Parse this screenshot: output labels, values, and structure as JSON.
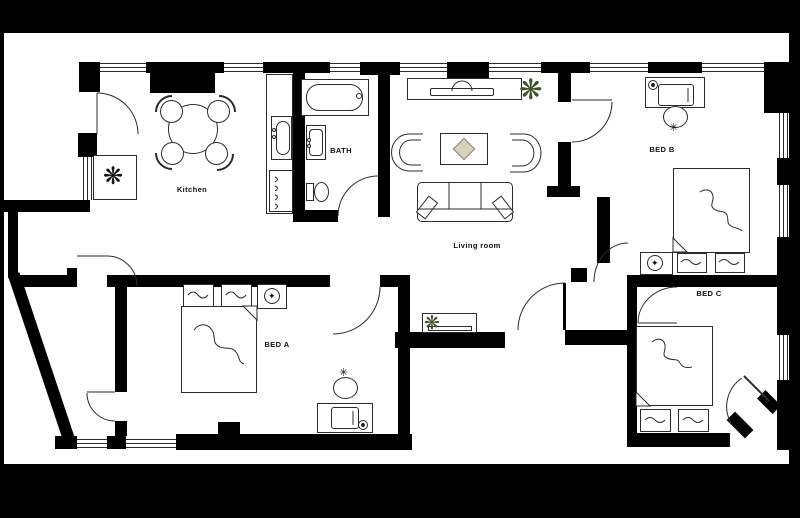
{
  "page": {
    "background": "#000000",
    "sheet": "#ffffff"
  },
  "colors": {
    "wall": "#000000",
    "line": "#2b2b2b",
    "plant_green": "#3d5226",
    "decor_beige": "#d8d0bd"
  },
  "rooms": [
    {
      "id": "kitchen",
      "label": "Kitchen"
    },
    {
      "id": "bath",
      "label": "BATH"
    },
    {
      "id": "living-room",
      "label": "Living room"
    },
    {
      "id": "bed-a",
      "label": "BED A"
    },
    {
      "id": "bed-b",
      "label": "BED B"
    },
    {
      "id": "bed-c",
      "label": "BED C"
    }
  ],
  "symbols": {
    "freezer": "❋",
    "plant": "❋",
    "fan_small": "✦",
    "chair_fan": "✳"
  }
}
